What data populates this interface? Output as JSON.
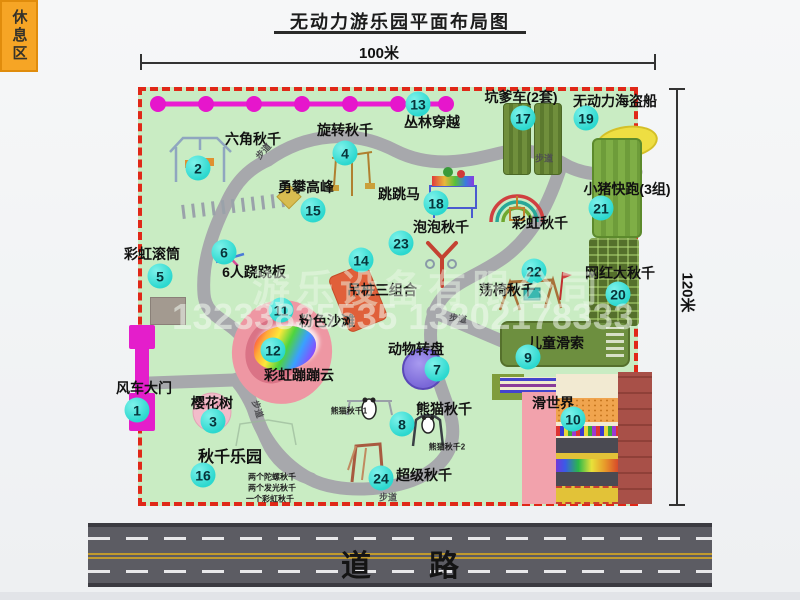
{
  "title": "无动力游乐园平面布局图",
  "dimensions": {
    "top": "100米",
    "right": "120米"
  },
  "road": {
    "label": "道路"
  },
  "path_label": "步道",
  "watermark": {
    "company": "游乐设备有限公司",
    "phone": "13233835535 13202178333"
  },
  "rest_area": "休息区",
  "colors": {
    "map_green": "#c9ecc3",
    "border_red": "#e02818",
    "walkway_gray": "#a7a8ac",
    "badge_cyan": "#2cd8cf",
    "chain_magenta": "#e616cc",
    "gate_magenta": "#e41ecb",
    "rest_orange": "#f6a525",
    "pirate_yellow": "#eede42",
    "turntable_purple": "#7a68d8",
    "beach_pink": "#ee97a3"
  },
  "items": [
    {
      "num": "1",
      "label": "风车大门"
    },
    {
      "num": "2",
      "label": "六角秋千"
    },
    {
      "num": "3",
      "label": "樱花树"
    },
    {
      "num": "4",
      "label": "旋转秋千"
    },
    {
      "num": "5",
      "label": "彩虹滚筒"
    },
    {
      "num": "6",
      "label": "6人跷跷板"
    },
    {
      "num": "7",
      "label": "动物转盘"
    },
    {
      "num": "8",
      "label": "熊猫秋千",
      "sub1": "熊猫秋千1",
      "sub2": "熊猫秋千2"
    },
    {
      "num": "9",
      "label": "儿童滑索"
    },
    {
      "num": "10",
      "label": "滑世界"
    },
    {
      "num": "11",
      "label": "粉色沙滩"
    },
    {
      "num": "12",
      "label": "彩虹蹦蹦云"
    },
    {
      "num": "13",
      "label": "丛林穿越"
    },
    {
      "num": "14",
      "label": "吊桩三组合"
    },
    {
      "num": "15",
      "label": "勇攀高峰"
    },
    {
      "num": "16",
      "label": "秋千乐园",
      "notes": [
        "两个陀螺秋千",
        "两个发光秋千",
        "一个彩虹秋千"
      ]
    },
    {
      "num": "17",
      "label": "坑爹车(2套)"
    },
    {
      "num": "18",
      "label": "跳跳马"
    },
    {
      "num": "19",
      "label": "无动力海盗船"
    },
    {
      "num": "20",
      "label": "网红大秋千"
    },
    {
      "num": "21",
      "label": "小猪快跑(3组)"
    },
    {
      "num": "22",
      "label": "荡椅秋千"
    },
    {
      "num": "23",
      "label": "泡泡秋千"
    },
    {
      "num": "24",
      "label": "超级秋千"
    },
    {
      "num": "",
      "label": "彩虹秋千"
    }
  ]
}
